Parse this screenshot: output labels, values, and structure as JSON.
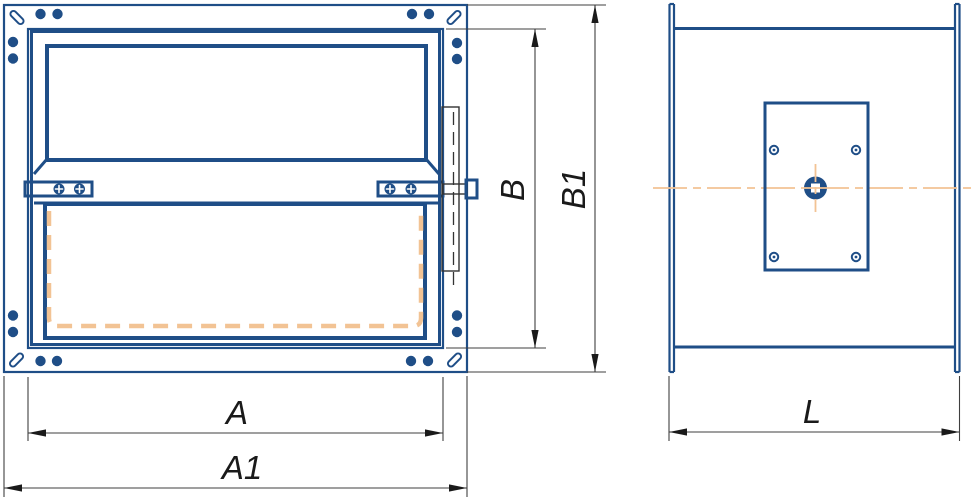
{
  "dimensions": {
    "A": {
      "label": "A"
    },
    "A1": {
      "label": "A1"
    },
    "B": {
      "label": "B"
    },
    "B1": {
      "label": "B1"
    },
    "L": {
      "label": "L"
    }
  },
  "colors": {
    "line-blue": "#1f4e87",
    "phantom-orange": "#f2c394",
    "hidden-line": "#333333",
    "dim-line": "#3f3f3f",
    "dim-text": "#1a1a1a",
    "background": "#ffffff"
  }
}
